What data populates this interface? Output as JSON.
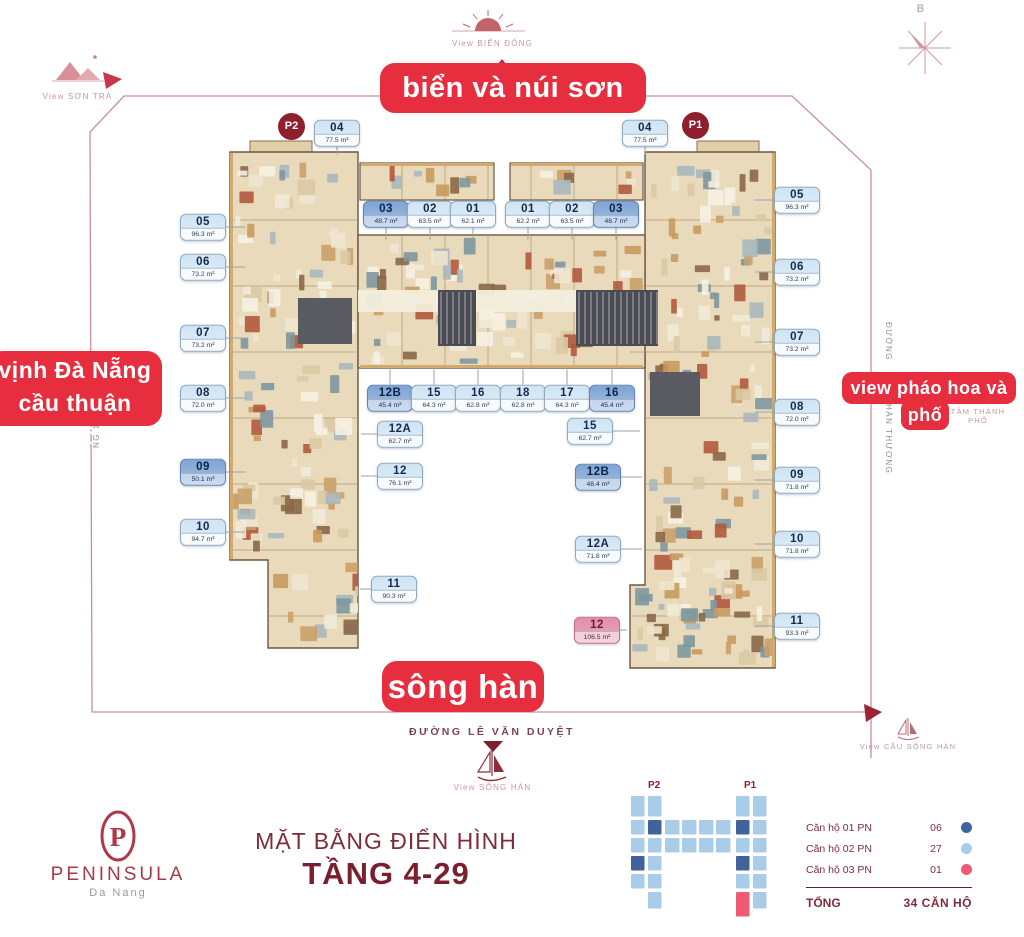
{
  "colors": {
    "accent": "#e62e3f",
    "maroon": "#7e2d38",
    "badge": "#8e1f2e",
    "type1_1pn": "#7fa5d5",
    "type2_2pn": "#cfe4f3",
    "type3_3pn": "#e08fa9",
    "legend_dot_1pn": "#41639c",
    "legend_dot_2pn": "#a9cce9",
    "legend_dot_3pn": "#ef5b74"
  },
  "banners": {
    "top": "biển và núi sơn trà",
    "left_line1": "vịnh Đà Nẵng",
    "left_line2": "cầu thuận phước",
    "right_line1": "view pháo hoa và Thành",
    "right_line2": "phố",
    "bottom": "sông hàn"
  },
  "views": {
    "north": "B",
    "bien_dong": "View BIỂN ĐÔNG",
    "son_tra": "View SƠN TRÀ",
    "song_han": "View SÔNG HÀN",
    "cau_song_han": "View CẦU SÔNG HÀN",
    "city_center": "TÂM THÀNH PHỐ"
  },
  "streets": {
    "bottom": "ĐƯỜNG LÊ VĂN DUYỆT",
    "right_upper": "ĐƯỜNG",
    "right_lower": "HÀN THƯƠNG",
    "left": "NG 1"
  },
  "towers": {
    "p2": "P2",
    "p1": "P1"
  },
  "units": [
    {
      "id": "04",
      "area": "77.5 m²",
      "type": 2,
      "x": 337,
      "y": 133,
      "lead": "d",
      "len": 8
    },
    {
      "id": "03",
      "area": "48.7 m²",
      "type": 1,
      "x": 386,
      "y": 214,
      "lead": "d",
      "len": 12
    },
    {
      "id": "02",
      "area": "63.5 m²",
      "type": 2,
      "x": 430,
      "y": 214,
      "lead": "d",
      "len": 12
    },
    {
      "id": "01",
      "area": "62.1 m²",
      "type": 2,
      "x": 473,
      "y": 214,
      "lead": "d",
      "len": 12
    },
    {
      "id": "05",
      "area": "96.3 m²",
      "type": 2,
      "x": 203,
      "y": 227,
      "lead": "r",
      "len": 20
    },
    {
      "id": "06",
      "area": "73.2 m²",
      "type": 2,
      "x": 203,
      "y": 267,
      "lead": "r",
      "len": 20
    },
    {
      "id": "07",
      "area": "73.2 m²",
      "type": 2,
      "x": 203,
      "y": 338,
      "lead": "r",
      "len": 20
    },
    {
      "id": "08",
      "area": "72.0 m²",
      "type": 2,
      "x": 203,
      "y": 398,
      "lead": "r",
      "len": 20
    },
    {
      "id": "09",
      "area": "50.1 m²",
      "type": 1,
      "x": 203,
      "y": 472,
      "lead": "r",
      "len": 20
    },
    {
      "id": "10",
      "area": "94.7 m²",
      "type": 2,
      "x": 203,
      "y": 532,
      "lead": "r",
      "len": 20
    },
    {
      "id": "12B",
      "area": "45.4 m²",
      "type": 1,
      "x": 390,
      "y": 398,
      "lead": "u",
      "len": 15
    },
    {
      "id": "15",
      "area": "64.3 m²",
      "type": 2,
      "x": 434,
      "y": 398,
      "lead": "u",
      "len": 15
    },
    {
      "id": "16",
      "area": "62.8 m²",
      "type": 2,
      "x": 478,
      "y": 398,
      "lead": "u",
      "len": 15
    },
    {
      "id": "12A",
      "area": "62.7 m²",
      "type": 2,
      "x": 400,
      "y": 434,
      "lead": "l",
      "len": 17
    },
    {
      "id": "12",
      "area": "76.1 m²",
      "type": 2,
      "x": 400,
      "y": 476,
      "lead": "l",
      "len": 17
    },
    {
      "id": "11",
      "area": "90.3 m²",
      "type": 2,
      "x": 394,
      "y": 589,
      "lead": "l",
      "len": 12
    },
    {
      "id": "01",
      "area": "62.2 m²",
      "type": 2,
      "x": 528,
      "y": 214,
      "lead": "d",
      "len": 12
    },
    {
      "id": "02",
      "area": "63.5 m²",
      "type": 2,
      "x": 572,
      "y": 214,
      "lead": "d",
      "len": 12
    },
    {
      "id": "03",
      "area": "48.7 m²",
      "type": 1,
      "x": 616,
      "y": 214,
      "lead": "d",
      "len": 12
    },
    {
      "id": "04",
      "area": "77.5 m²",
      "type": 2,
      "x": 645,
      "y": 133,
      "lead": "d",
      "len": 8
    },
    {
      "id": "18",
      "area": "62.8 m²",
      "type": 2,
      "x": 523,
      "y": 398,
      "lead": "u",
      "len": 15
    },
    {
      "id": "17",
      "area": "64.3 m²",
      "type": 2,
      "x": 567,
      "y": 398,
      "lead": "u",
      "len": 15
    },
    {
      "id": "16",
      "area": "45.4 m²",
      "type": 1,
      "x": 612,
      "y": 398,
      "lead": "u",
      "len": 15
    },
    {
      "id": "15",
      "area": "62.7 m²",
      "type": 2,
      "x": 590,
      "y": 431,
      "lead": "r",
      "len": 28
    },
    {
      "id": "12B",
      "area": "48.4 m²",
      "type": 1,
      "x": 598,
      "y": 477,
      "lead": "r",
      "len": 22
    },
    {
      "id": "12A",
      "area": "71.8 m²",
      "type": 2,
      "x": 598,
      "y": 549,
      "lead": "r",
      "len": 22
    },
    {
      "id": "12",
      "area": "106.5 m²",
      "type": 3,
      "x": 597,
      "y": 630,
      "lead": "r",
      "len": 8
    },
    {
      "id": "05",
      "area": "96.3 m²",
      "type": 2,
      "x": 797,
      "y": 200,
      "lead": "l",
      "len": 20
    },
    {
      "id": "06",
      "area": "73.2 m²",
      "type": 2,
      "x": 797,
      "y": 272,
      "lead": "l",
      "len": 20
    },
    {
      "id": "07",
      "area": "73.2 m²",
      "type": 2,
      "x": 797,
      "y": 342,
      "lead": "l",
      "len": 20
    },
    {
      "id": "08",
      "area": "72.0 m²",
      "type": 2,
      "x": 797,
      "y": 412,
      "lead": "l",
      "len": 20
    },
    {
      "id": "09",
      "area": "71.8 m²",
      "type": 2,
      "x": 797,
      "y": 480,
      "lead": "l",
      "len": 20
    },
    {
      "id": "10",
      "area": "71.8 m²",
      "type": 2,
      "x": 797,
      "y": 544,
      "lead": "l",
      "len": 20
    },
    {
      "id": "11",
      "area": "93.3 m²",
      "type": 2,
      "x": 797,
      "y": 626,
      "lead": "l",
      "len": 20
    }
  ],
  "footer": {
    "brand": "PENINSULA",
    "brand_sub": "Da Nang",
    "title_line1": "MẶT BẰNG ĐIỂN HÌNH",
    "title_line2": "TẦNG 4-29",
    "mini_p2": "P2",
    "mini_p1": "P1"
  },
  "legend": {
    "rows": [
      {
        "label": "Căn hộ 01 PN",
        "value": "06"
      },
      {
        "label": "Căn hộ 02 PN",
        "value": "27"
      },
      {
        "label": "Căn hộ 03 PN",
        "value": "01"
      }
    ],
    "total_label": "TỔNG",
    "total_value": "34 CĂN HỘ"
  }
}
